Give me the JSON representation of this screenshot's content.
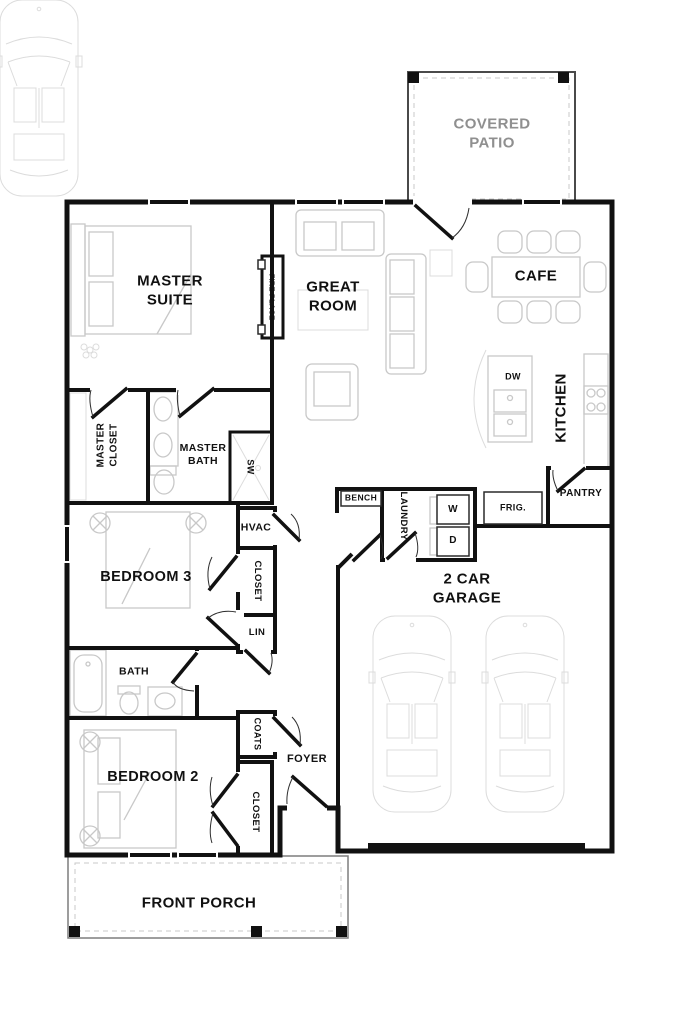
{
  "meta": {
    "title": "Single-story house floor plan"
  },
  "colors": {
    "wall": "#111111",
    "label": "#111111",
    "patio_label": "#8f8f8f",
    "bg": "#ffffff",
    "furniture_line": "#c8c8c8"
  },
  "rooms": {
    "covered_patio": {
      "label": "COVERED PATIO"
    },
    "master_suite": {
      "label": "MASTER SUITE"
    },
    "great_room": {
      "label": "GREAT ROOM"
    },
    "cafe": {
      "label": "CAFE"
    },
    "kitchen": {
      "label": "KITCHEN"
    },
    "fireplace": {
      "label": "FIRE PLACE"
    },
    "master_closet": {
      "label": "MASTER CLOSET"
    },
    "master_bath": {
      "label": "MASTER BATH"
    },
    "shower": {
      "label": "SW"
    },
    "hvac": {
      "label": "HVAC"
    },
    "bedroom3": {
      "label": "BEDROOM 3"
    },
    "closet_bedroom3": {
      "label": "CLOSET"
    },
    "linen": {
      "label": "LIN"
    },
    "bath": {
      "label": "BATH"
    },
    "bedroom2": {
      "label": "BEDROOM 2"
    },
    "coats": {
      "label": "COATS"
    },
    "closet_bedroom2": {
      "label": "CLOSET"
    },
    "foyer": {
      "label": "FOYER"
    },
    "bench": {
      "label": "BENCH"
    },
    "laundry": {
      "label": "LAUNDRY"
    },
    "washer": {
      "label": "W"
    },
    "dryer": {
      "label": "D"
    },
    "dishwasher": {
      "label": "DW"
    },
    "refrigerator": {
      "label": "FRIG."
    },
    "pantry": {
      "label": "PANTRY"
    },
    "garage": {
      "label": "2 CAR GARAGE"
    },
    "front_porch": {
      "label": "FRONT PORCH"
    }
  }
}
